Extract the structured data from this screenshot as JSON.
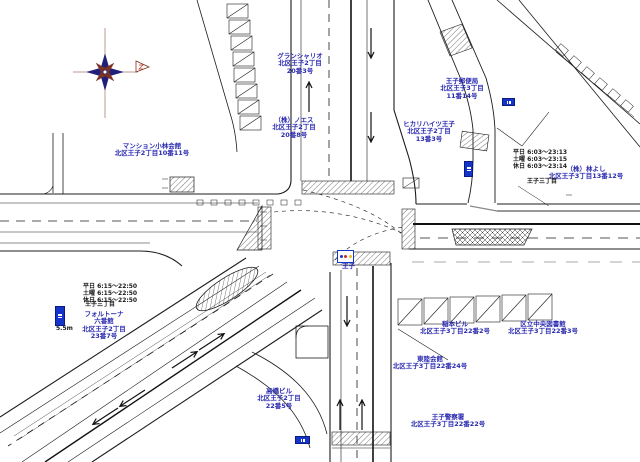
{
  "colors": {
    "label_blue": "#2b2bb0",
    "label_black": "#1a1a1a",
    "road_line": "#1c1c1c",
    "road_gray": "#8a8a8a",
    "sign_blue": "#1535c8",
    "signal_red": "#d42a1e",
    "signal_yellow": "#e8c21a",
    "compass_navy": "#20207a",
    "compass_maroon": "#7c3222"
  },
  "icons": [
    "compass-rose",
    "north-pennant",
    "traffic-signal-sign",
    "bus-stop-sign"
  ],
  "map": {
    "labels": [
      {
        "id": "mansion-grand-chariot",
        "lines": [
          "グランシャリオ",
          "北区王子2丁目",
          "20番3号"
        ],
        "x": 300,
        "y": 53,
        "color": "blue",
        "align": "center"
      },
      {
        "id": "noesu",
        "lines": [
          "（株）ノエス",
          "北区王子2丁目",
          "20番8号"
        ],
        "x": 294,
        "y": 117,
        "color": "blue",
        "align": "center"
      },
      {
        "id": "mansion-kobayashi",
        "lines": [
          "マンション小林会館",
          "北区王子2丁目10番11号"
        ],
        "x": 152,
        "y": 143,
        "color": "blue",
        "align": "center"
      },
      {
        "id": "hikari-heights-oji",
        "lines": [
          "ヒカリハイツ王子",
          "北区王子2丁目",
          "13番3号"
        ],
        "x": 429,
        "y": 121,
        "color": "blue",
        "align": "center"
      },
      {
        "id": "oji-post-office",
        "lines": [
          "王子郵便局",
          "北区王子3丁目",
          "11番14号"
        ],
        "x": 462,
        "y": 78,
        "color": "blue",
        "align": "center"
      },
      {
        "id": "hayashi-yoshi",
        "lines": [
          "（株）林よし",
          "北区王子3丁目13番12号"
        ],
        "x": 586,
        "y": 166,
        "color": "blue",
        "align": "center"
      },
      {
        "id": "schedule-right",
        "lines": [
          "平日 6:03〜23:13",
          "土曜 6:03〜23:15",
          "休日 6:03〜23:14"
        ],
        "x": 513,
        "y": 150,
        "color": "black",
        "align": "left"
      },
      {
        "id": "oji-3chome-right",
        "lines": [
          "王子三丁目"
        ],
        "x": 527,
        "y": 179,
        "color": "black",
        "align": "left"
      },
      {
        "id": "schedule-left",
        "lines": [
          "平日 6:15〜22:50",
          "土曜 6:15〜22:50",
          "休日 6:15〜22:50"
        ],
        "x": 83,
        "y": 284,
        "color": "black",
        "align": "left"
      },
      {
        "id": "oji-3chome-left",
        "lines": [
          "王子三丁目"
        ],
        "x": 85,
        "y": 302,
        "color": "black",
        "align": "left"
      },
      {
        "id": "fortuna",
        "lines": [
          "フォルトーナ",
          "六番館",
          "北区王子2丁目",
          "23番7号"
        ],
        "x": 104,
        "y": 311,
        "color": "blue",
        "align": "center"
      },
      {
        "id": "inamoto-building",
        "lines": [
          "稲本ビル",
          "北区王子3丁目22番2号"
        ],
        "x": 455,
        "y": 321,
        "color": "blue",
        "align": "center"
      },
      {
        "id": "central-library",
        "lines": [
          "区立中央図書館",
          "北区王子3丁目22番3号"
        ],
        "x": 543,
        "y": 321,
        "color": "blue",
        "align": "center"
      },
      {
        "id": "toriku-kaikan",
        "lines": [
          "東陸会館",
          "北区王子3丁目22番24号"
        ],
        "x": 430,
        "y": 356,
        "color": "blue",
        "align": "center"
      },
      {
        "id": "takahashi-building",
        "lines": [
          "高橋ビル",
          "北区王子2丁目",
          "22番5号"
        ],
        "x": 279,
        "y": 388,
        "color": "blue",
        "align": "center"
      },
      {
        "id": "oji-police-station",
        "lines": [
          "王子警察署",
          "北区王子3丁目22番22号"
        ],
        "x": 448,
        "y": 414,
        "color": "blue",
        "align": "center"
      },
      {
        "id": "signal-name",
        "lines": [
          "王子"
        ],
        "x": 342,
        "y": 263,
        "color": "blue",
        "align": "left"
      },
      {
        "id": "height-note",
        "lines": [
          "5.5m"
        ],
        "x": 56,
        "y": 326,
        "color": "black",
        "align": "left"
      }
    ],
    "signs": [
      {
        "id": "bus-stop-sign-north",
        "x": 502,
        "y": 98,
        "w": 11,
        "h": 6,
        "type": "h"
      },
      {
        "id": "bus-stop-sign-east",
        "x": 464,
        "y": 161,
        "w": 7,
        "h": 14,
        "type": "v"
      },
      {
        "id": "bus-stop-sign-west",
        "x": 55,
        "y": 306,
        "w": 8,
        "h": 18,
        "type": "v"
      },
      {
        "id": "bus-stop-sign-south",
        "x": 295,
        "y": 436,
        "w": 13,
        "h": 6,
        "type": "h"
      },
      {
        "id": "traffic-signal-sign",
        "x": 337,
        "y": 250,
        "w": 15,
        "h": 11,
        "type": "signal"
      }
    ]
  }
}
